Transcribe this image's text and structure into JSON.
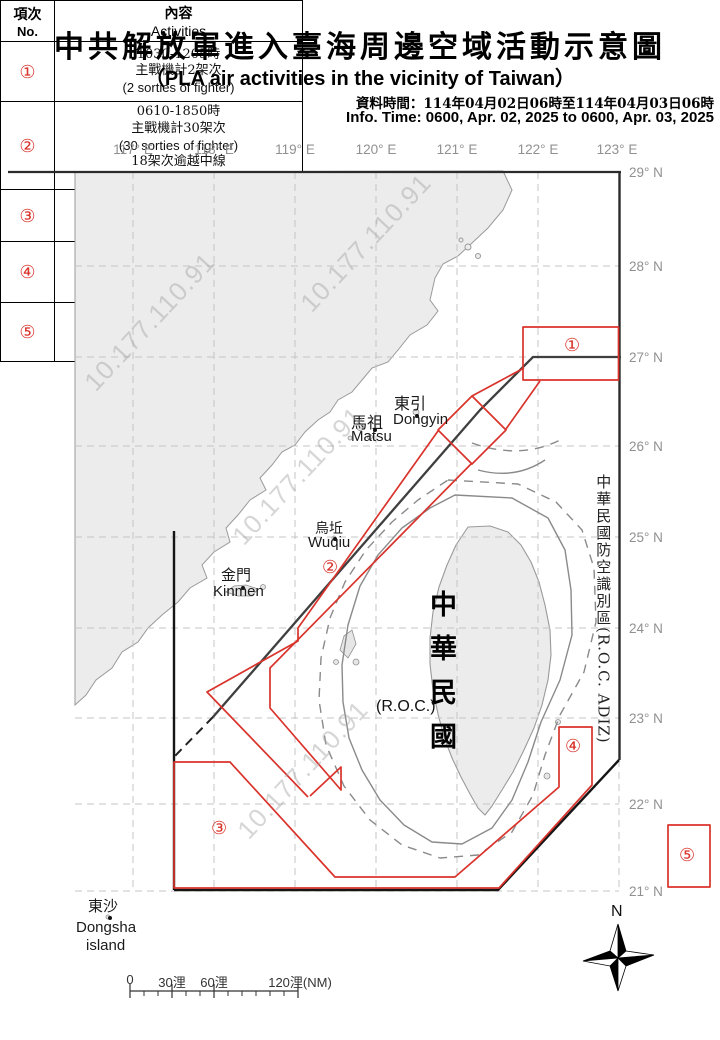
{
  "title": {
    "cjk": "中共解放軍進入臺海周邊空域活動示意圖",
    "en": "（PLA air activities in the vicinity of Taiwan）"
  },
  "info": {
    "cjk": "資料時間：114年04月02日06時至114年04月03日06時",
    "en": "Info. Time: 0600, Apr. 02, 2025 to 0600, Apr. 03, 2025"
  },
  "table": {
    "header": {
      "col1_cjk": "項次",
      "col1_en": "No.",
      "col2_cjk": "內容",
      "col2_en": "Activities"
    },
    "rows": [
      {
        "no": "①",
        "lines": [
          "1030-1205時",
          "主戰機計2架次",
          "(2 sorties of fighter)"
        ]
      },
      {
        "no": "②",
        "lines": [
          "0610-1850時",
          "主戰機計30架次",
          "(30 sorties of fighter)",
          "18架次逾越中線",
          "(18 sorties crossed the median line)"
        ]
      },
      {
        "no": "③",
        "lines": [
          "1420-2010時",
          "主、輔戰機計5架次",
          "(5 sorties of fighter / support aircraft)"
        ]
      },
      {
        "no": "④",
        "lines": [
          "1425-1720時",
          "主戰機計6架次",
          "(6 sorties of fighter / bomber)"
        ]
      },
      {
        "no": "⑤",
        "lines": [
          "0800-1715時",
          "主戰機及直升機計16架次",
          "(16 sorties of fighter / helicopter)"
        ]
      }
    ]
  },
  "map": {
    "lon_labels": [
      "117° E",
      "118° E",
      "119° E",
      "120° E",
      "121° E",
      "122° E",
      "123° E"
    ],
    "lat_labels": [
      "29° N",
      "28° N",
      "27° N",
      "26° N",
      "25° N",
      "24° N",
      "23° N",
      "22° N",
      "21° N"
    ],
    "places": [
      {
        "id": "dongyin",
        "cjk": "東引",
        "en": "Dongyin"
      },
      {
        "id": "matsu",
        "cjk": "馬祖",
        "en": "Matsu"
      },
      {
        "id": "wuqiu",
        "cjk": "烏坵",
        "en": "Wuqiu"
      },
      {
        "id": "kinmen",
        "cjk": "金門",
        "en": "Kinmen"
      },
      {
        "id": "dongsha",
        "cjk": "東沙",
        "en": "Dongsha",
        "en2": "island"
      }
    ],
    "roc_cjk": "中華民國",
    "roc_en": "(R.O.C.)",
    "adiz_cjk": "中華民國防空識別區",
    "adiz_en": "(R.O.C. ADIZ)",
    "zone_markers": [
      "①",
      "②",
      "③",
      "④",
      "⑤"
    ],
    "compass_n": "N",
    "scale_labels": [
      "0",
      "30浬",
      "60浬",
      "120浬(NM)"
    ],
    "watermark": "10.177.110.91"
  },
  "colors": {
    "red": "#d9332b",
    "land": "#ececec",
    "coast": "#9a9a9a",
    "grid": "#c4c4c4",
    "contour": "#8a8a8a",
    "median": "#3f3f3f",
    "adiz_line": "#151515",
    "label_gray": "#909090"
  }
}
